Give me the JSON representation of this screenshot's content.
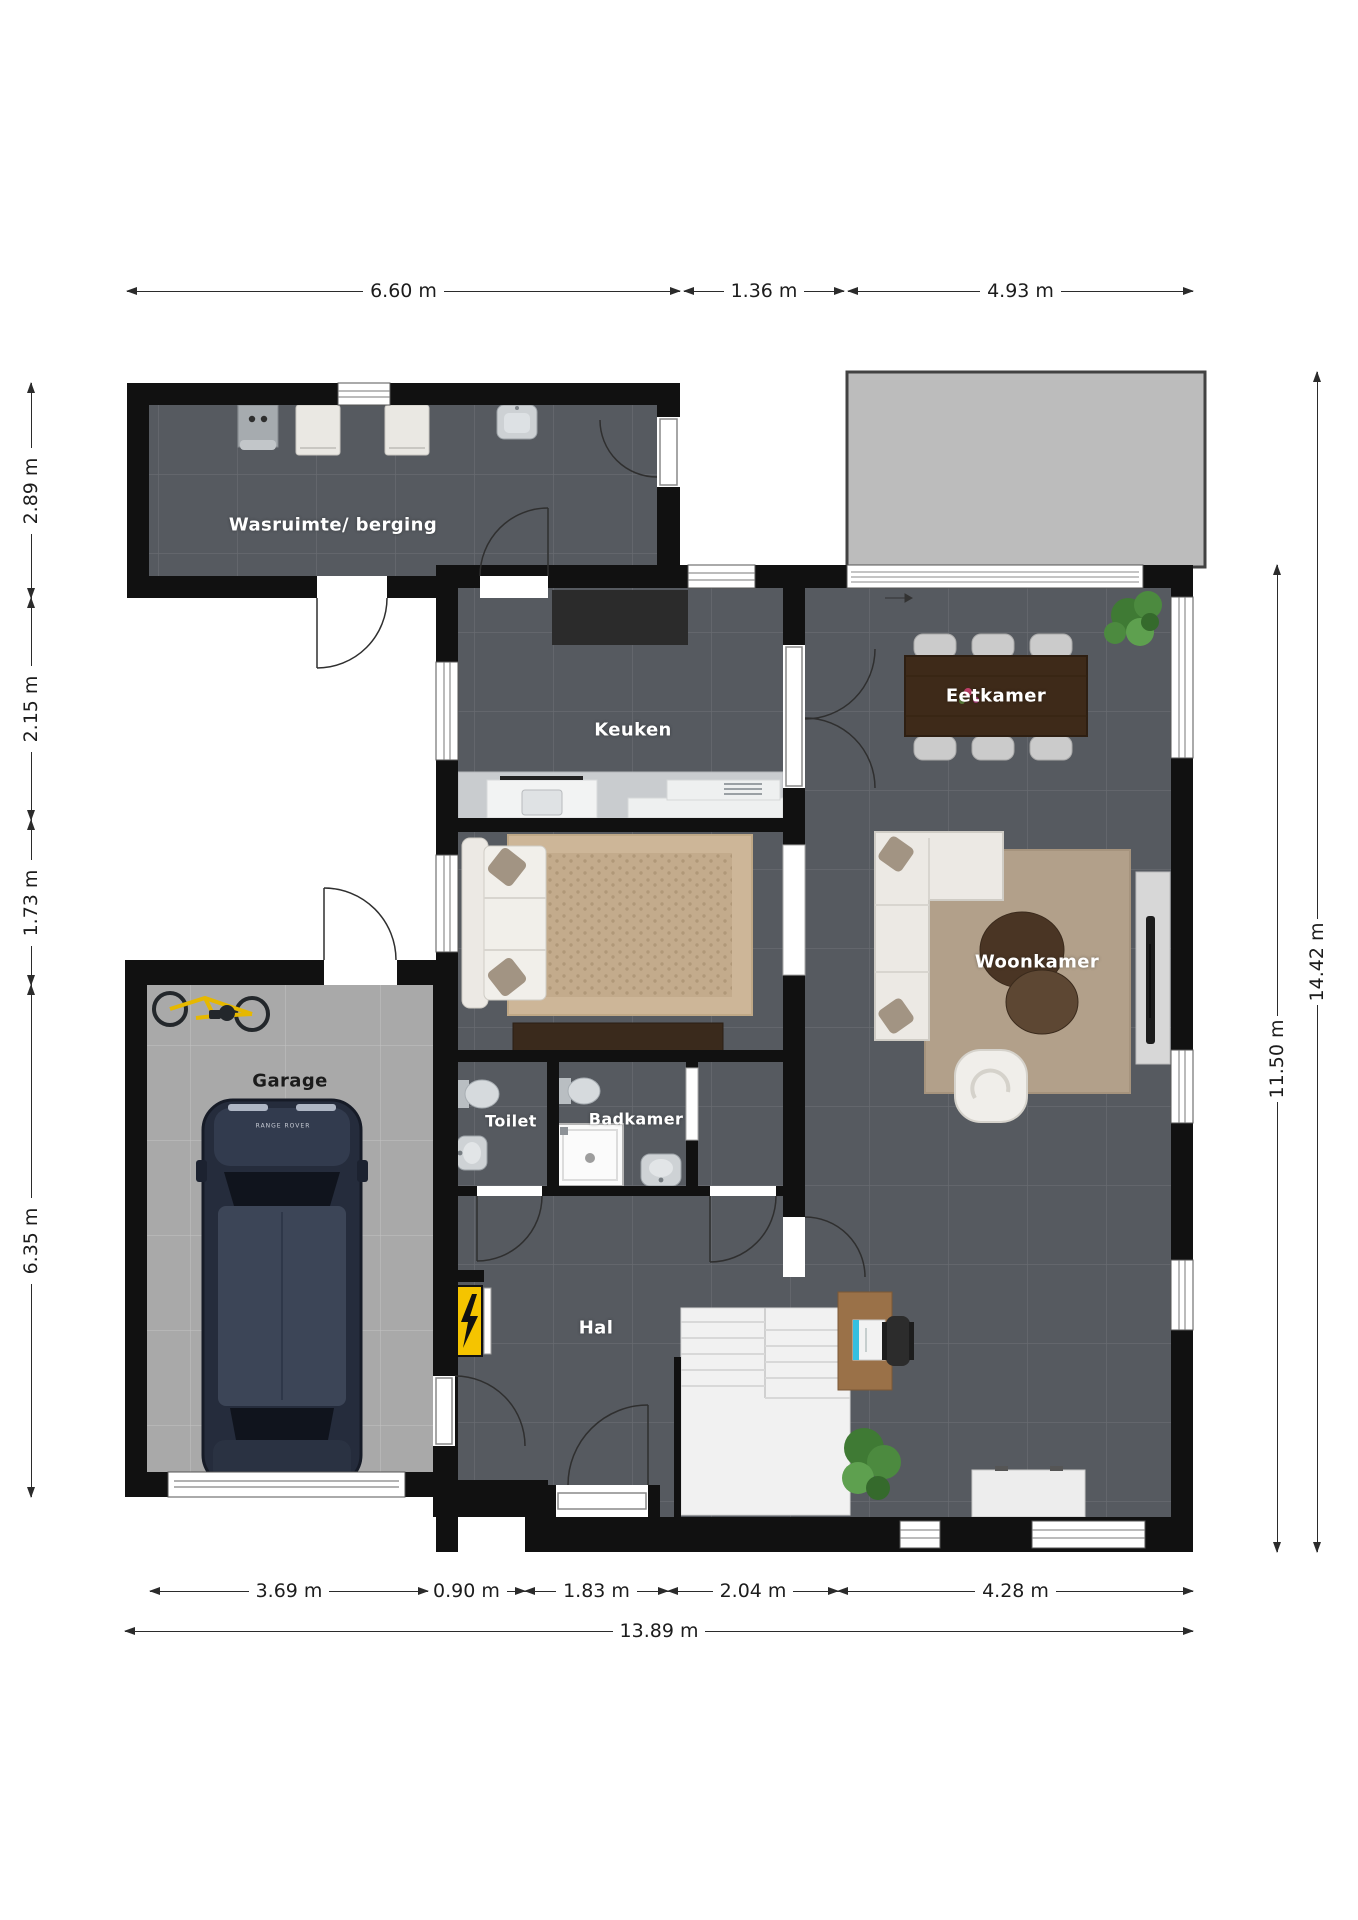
{
  "title": "Begane grond plattegrond",
  "rooms": [
    {
      "id": "wasruimte",
      "label": "Wasruimte/ berging"
    },
    {
      "id": "keuken",
      "label": "Keuken"
    },
    {
      "id": "eetkamer",
      "label": "Eetkamer"
    },
    {
      "id": "woonkamer",
      "label": "Woonkamer"
    },
    {
      "id": "garage",
      "label": "Garage"
    },
    {
      "id": "toilet",
      "label": "Toilet"
    },
    {
      "id": "badkamer",
      "label": "Badkamer"
    },
    {
      "id": "hal",
      "label": "Hal"
    }
  ],
  "dimensions": {
    "top": [
      {
        "label": "6.60 m"
      },
      {
        "label": "1.36 m"
      },
      {
        "label": "4.93 m"
      }
    ],
    "left": [
      {
        "label": "2.89 m"
      },
      {
        "label": "2.15 m"
      },
      {
        "label": "1.73 m"
      },
      {
        "label": "6.35 m"
      }
    ],
    "right": [
      {
        "label": "11.50 m"
      },
      {
        "label": "14.42 m"
      }
    ],
    "bottom": [
      {
        "label": "3.69 m"
      },
      {
        "label": "0.90 m"
      },
      {
        "label": "1.83 m"
      },
      {
        "label": "2.04 m"
      },
      {
        "label": "4.28 m"
      }
    ],
    "total_width": {
      "label": "13.89 m"
    }
  },
  "car_badge": {
    "label": "RANGE ROVER"
  },
  "colors": {
    "wall": "#111111",
    "floor_dark": "#565a60",
    "floor_garage": "#a9a9a9",
    "terrace": "#bcbcbc",
    "electrical_panel": "#f5c400",
    "rug_lounge": "#c9b295",
    "rug_living": "#b2a08a",
    "dining_table": "#3e2a19",
    "sofa": "#ece9e4",
    "plant": "#4c8a3f",
    "car": "#252c3c"
  }
}
